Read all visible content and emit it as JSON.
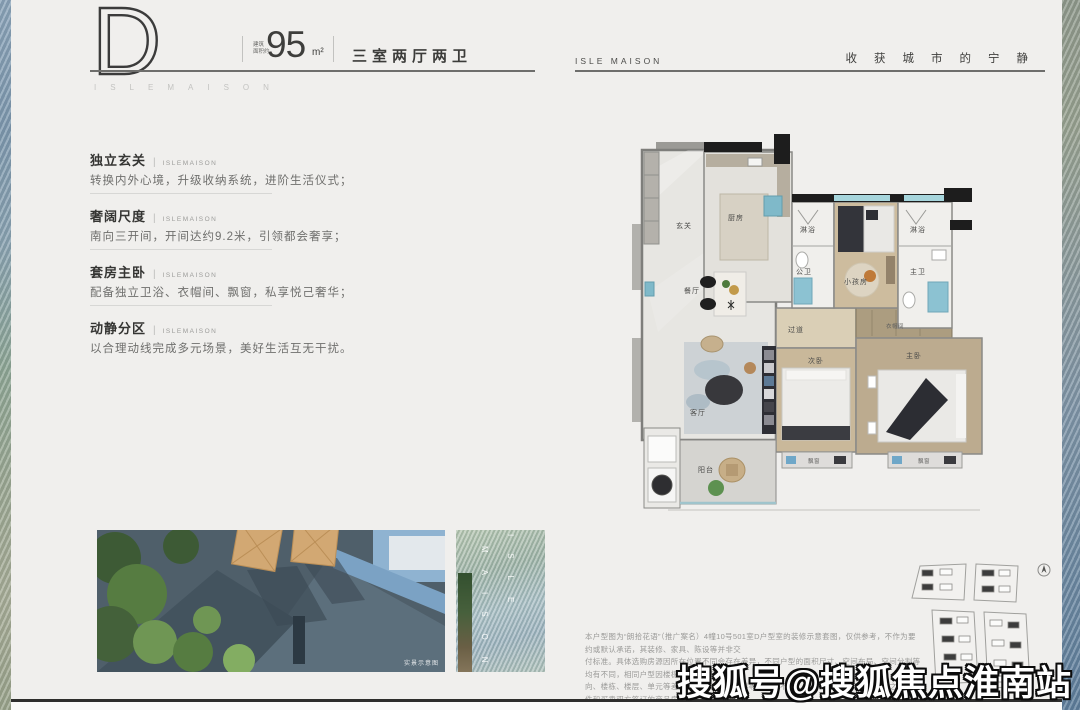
{
  "header": {
    "plan_letter": "D",
    "area_label_line1": "建筑",
    "area_label_line2": "面积约",
    "area_value": "95",
    "area_unit": "m²",
    "layout_text": "三室两厅两卫",
    "brand_spaced": "ISLEMAISON",
    "brand_right": "ISLE MAISON",
    "slogan": "收获城市的宁静"
  },
  "features": [
    {
      "title": "独立玄关",
      "tag": "ISLEMAISON",
      "desc": "转换内外心境，升级收纳系统，进阶生活仪式；"
    },
    {
      "title": "奢阔尺度",
      "tag": "ISLEMAISON",
      "desc": "南向三开间，开间达约9.2米，引领都会奢享；"
    },
    {
      "title": "套房主卧",
      "tag": "ISLEMAISON",
      "desc": "配备独立卫浴、衣帽间、飘窗，私享悦己奢华；"
    },
    {
      "title": "动静分区",
      "tag": "ISLEMAISON",
      "desc": "以合理动线完成多元场景，美好生活互无干扰。"
    }
  ],
  "floorplan": {
    "rooms": {
      "entry": "玄关",
      "kitchen": "厨房",
      "dining": "餐厅",
      "living": "客厅",
      "balcony": "阳台",
      "corridor": "过道",
      "shower_left": "淋浴",
      "bath_public": "公卫",
      "kids_room": "小孩房",
      "shower_right": "淋浴",
      "bath_master": "主卫",
      "bedroom_second": "次卧",
      "bedroom_master": "主卧",
      "cloakroom": "衣帽间",
      "bay_window_left": "飘窗",
      "bay_window_right": "飘窗"
    }
  },
  "gallery": {
    "photo_caption": "实景示意图",
    "strip_letters_col1": "MAISON",
    "strip_letters_col2": "ISLE"
  },
  "disclaimer": {
    "lines": [
      "本户型图为“朗拾花语”（推广案名）4幢10号501室D户型室的装修示意套图，仅供参考，不作为要约或默认承诺，其装修、家具、陈设等并非交",
      "付标准。具体选购房源因所在位置不同会存在差异，不同户型的面积尺寸、空间布局、空间分割等均有不同，相同户型因楼栋位置差异与空间朝",
      "向、楼栋、楼层、单元等差别，结构结构、用料等也可能不同，具体情况以政府最终核准之法律文件和买卖双方签订的商品房买卖合同为",
      "准。本项目政府备案核准名为“朗拾花语苑”，本资料制作时间为2025年6月29日，相关变化不再另行通知，请留意最新资料。"
    ]
  },
  "watermark": {
    "text": "搜狐号@搜狐焦点淮南站"
  },
  "icons": {
    "compass": "compass-icon"
  },
  "colors": {
    "page_bg": "#f0efed",
    "text_dark": "#3c3c3a",
    "text_gray": "#9a9a98",
    "window_teal": "#a6d5dc",
    "wood": "#c9b89a",
    "wall_black": "#1d1d1d"
  }
}
